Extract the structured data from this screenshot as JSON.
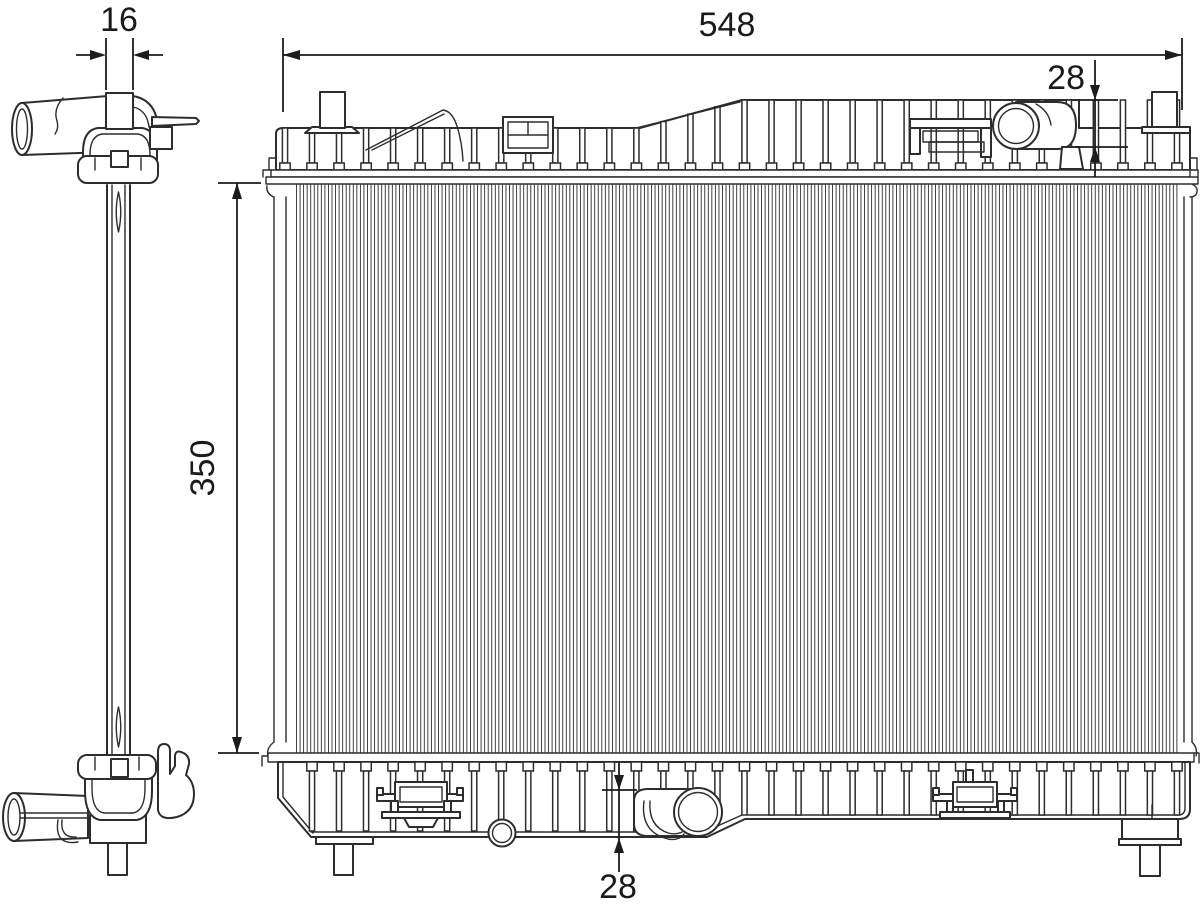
{
  "drawing": {
    "type": "technical-line-drawing",
    "subject": "radiator-two-view-drawing",
    "background_color": "#ffffff",
    "line_color": "#2d2d2d",
    "dimensions": {
      "tank_depth": {
        "label": "16"
      },
      "overall_width": {
        "label": "548"
      },
      "inlet_offset": {
        "label": "28"
      },
      "core_height": {
        "label": "350"
      },
      "outlet_offset": {
        "label": "28"
      }
    }
  }
}
